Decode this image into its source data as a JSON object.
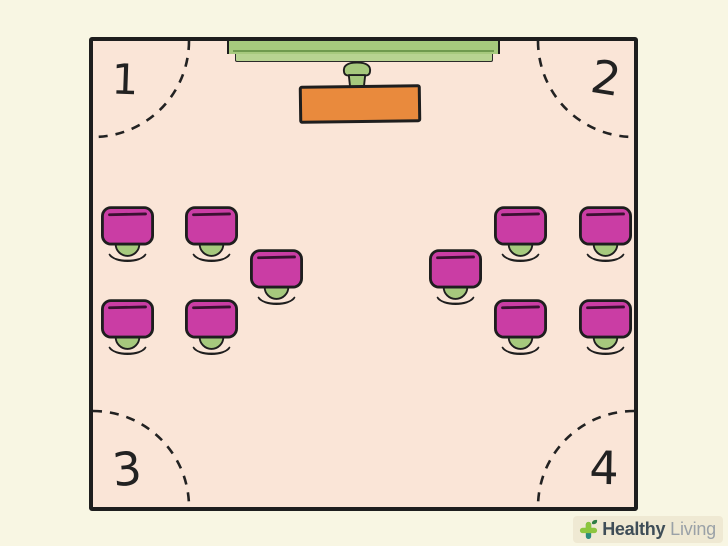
{
  "illustration": {
    "description": "Classroom floor plan with numbered corners",
    "colors": {
      "background": "#f8f6e3",
      "floor": "#fae5d7",
      "ink": "#1e1e1e",
      "desk_magenta": "#ca3da4",
      "desk_groove": "#3a1031",
      "chair_green": "#a6c97d",
      "board_green": "#a6c97d",
      "board_tray_green": "#b7d391",
      "board_line_green": "#6f9a4e",
      "teacher_desk_orange": "#e98a3d"
    },
    "room": {
      "corners": [
        {
          "label": "1",
          "position": "top-left"
        },
        {
          "label": "2",
          "position": "top-right"
        },
        {
          "label": "3",
          "position": "bottom-left"
        },
        {
          "label": "4",
          "position": "bottom-right"
        }
      ],
      "student_desks": [
        {
          "x": 101,
          "y": 206,
          "group": "left"
        },
        {
          "x": 185,
          "y": 206,
          "group": "left"
        },
        {
          "x": 250,
          "y": 249,
          "group": "left"
        },
        {
          "x": 101,
          "y": 299,
          "group": "left"
        },
        {
          "x": 185,
          "y": 299,
          "group": "left"
        },
        {
          "x": 429,
          "y": 249,
          "group": "right"
        },
        {
          "x": 494,
          "y": 206,
          "group": "right"
        },
        {
          "x": 579,
          "y": 206,
          "group": "right"
        },
        {
          "x": 494,
          "y": 299,
          "group": "right"
        },
        {
          "x": 579,
          "y": 299,
          "group": "right"
        }
      ]
    },
    "logo": {
      "brand_bold": "Healthy",
      "brand_light": "Living",
      "plus_green": "#8cc63f",
      "plus_teal": "#2b8c7c",
      "leaf_green": "#2e7d44",
      "bold_text_color": "#3e4d57",
      "light_text_color": "#9aa1a7"
    }
  }
}
